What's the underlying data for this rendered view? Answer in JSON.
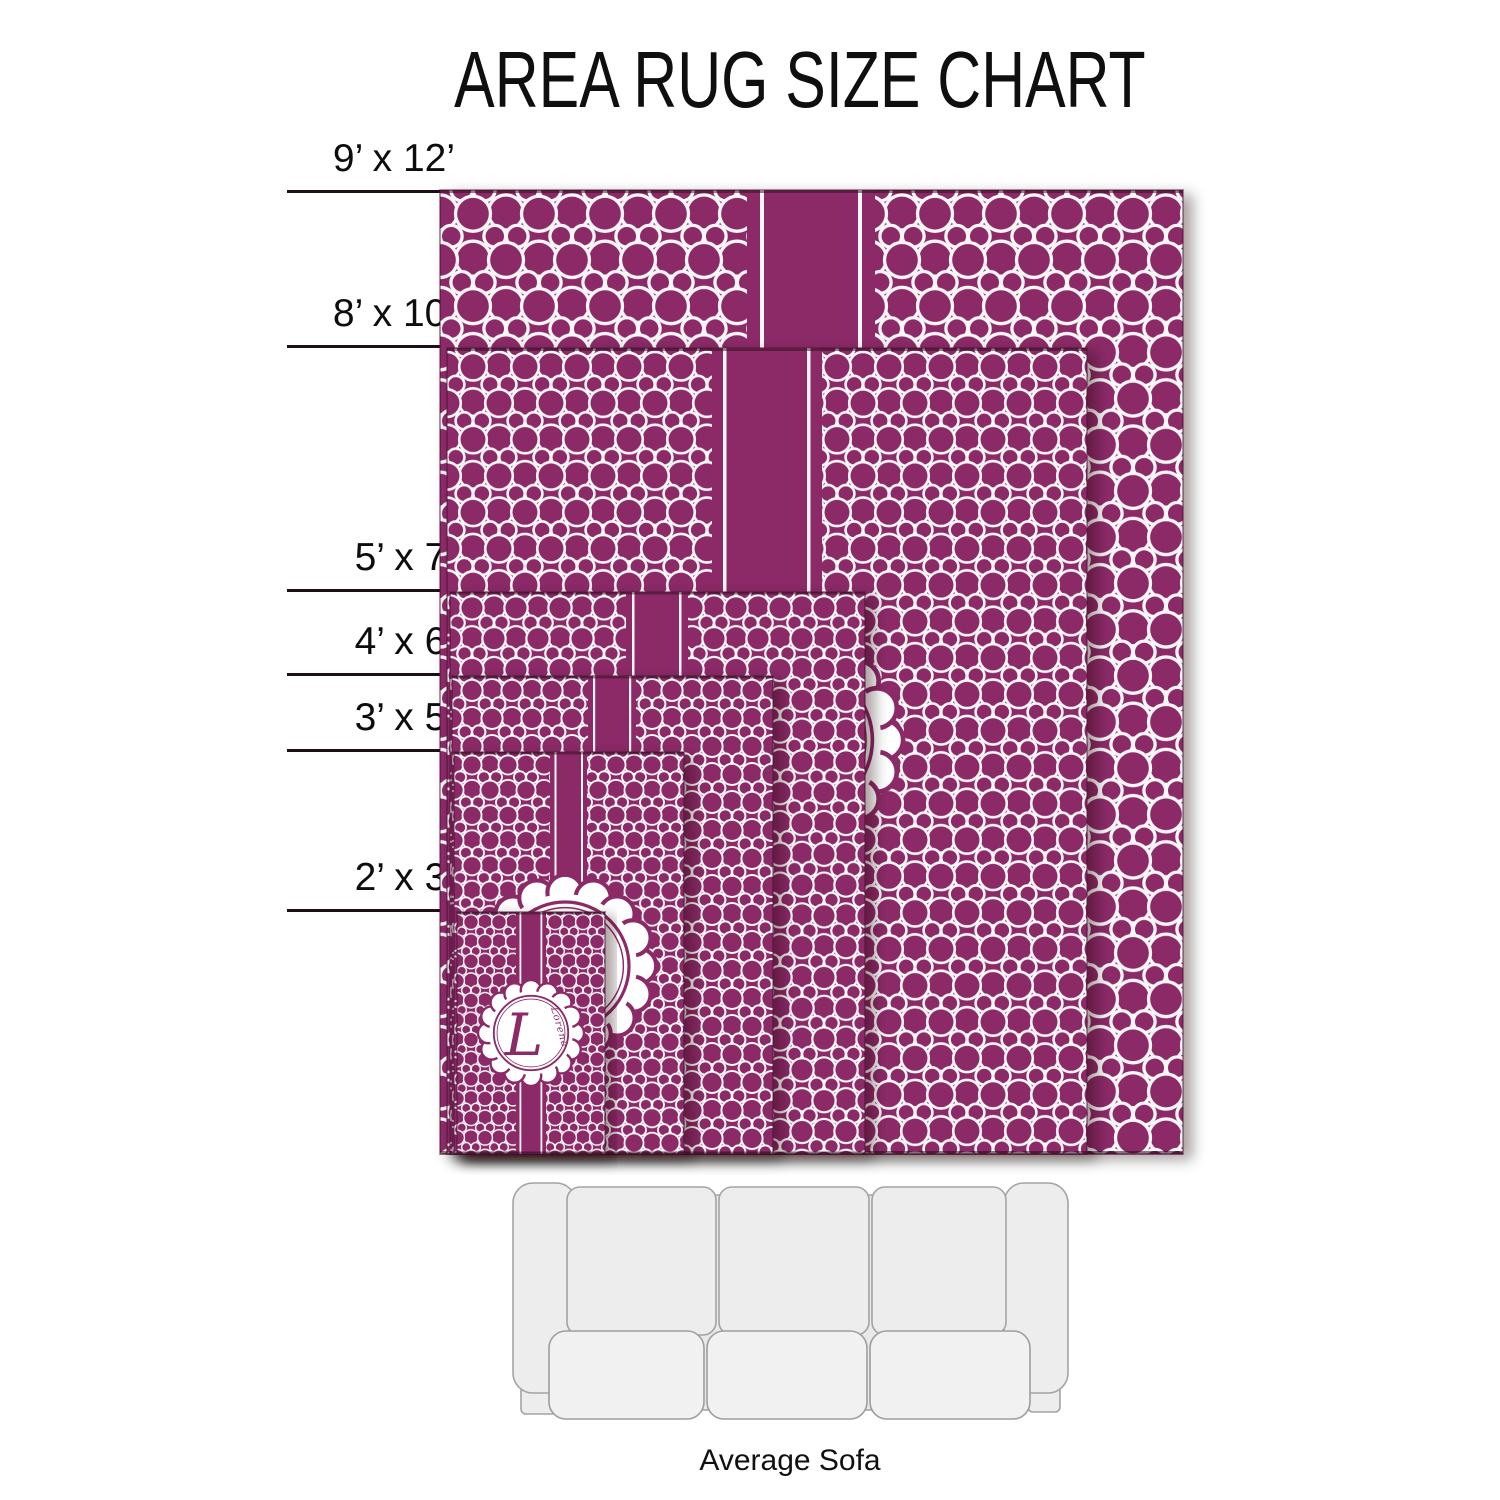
{
  "title": "AREA RUG SIZE CHART",
  "rugs": [
    {
      "id": "9x12",
      "label": "9’ x 12’",
      "width_ft": 9,
      "length_ft": 12
    },
    {
      "id": "8x10",
      "label": "8’ x 10’",
      "width_ft": 8,
      "length_ft": 10
    },
    {
      "id": "5x7",
      "label": "5’ x 7’",
      "width_ft": 5,
      "length_ft": 7
    },
    {
      "id": "4x6",
      "label": "4’ x 6’",
      "width_ft": 4,
      "length_ft": 6
    },
    {
      "id": "3x5",
      "label": "3’ x 5’",
      "width_ft": 3,
      "length_ft": 5
    },
    {
      "id": "2x3",
      "label": "2’ x 3’",
      "width_ft": 2,
      "length_ft": 3
    }
  ],
  "monogram": {
    "letter": "L",
    "name": "Lorena"
  },
  "sofa": {
    "caption": "Average Sofa"
  },
  "colors": {
    "rug_magenta": "#8C2A67",
    "pattern_white": "#F8F6F7",
    "text_black": "#0d0d0d",
    "dimension_line": "#1d0f18",
    "sofa_gray": "#EDEDED"
  }
}
